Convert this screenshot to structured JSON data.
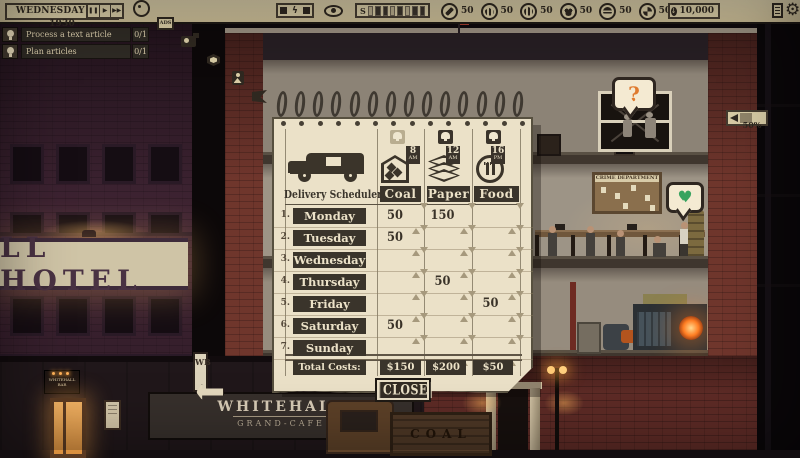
{
  "top_bar": {
    "date": "WEDNESDAY JAN 1930",
    "speed": {
      "pause": "❚❚",
      "play": "▶",
      "fast": "▶▶"
    },
    "ads_label": "ADS",
    "bolt": "ϟ",
    "s_label": "S",
    "stats": [
      {
        "icon": "leaf-circle-icon",
        "value": "50"
      },
      {
        "icon": "industry-circle-icon",
        "value": "50"
      },
      {
        "icon": "bank-circle-icon",
        "value": "50"
      },
      {
        "icon": "crowd-circle-icon",
        "value": "50"
      },
      {
        "icon": "portrait-circle-icon",
        "value": "50"
      },
      {
        "icon": "emblem-circle-icon",
        "value": "50"
      }
    ],
    "money": "10,000",
    "circulation": "50%"
  },
  "tasks": [
    {
      "label": "Process a text article",
      "progress": "0/1"
    },
    {
      "label": "Plan articles",
      "progress": "0/1"
    }
  ],
  "scheduler": {
    "title": "Delivery Scheduler",
    "columns": [
      {
        "label": "Coal",
        "hour": "8",
        "meridiem": "AM",
        "bell_active": false
      },
      {
        "label": "Paper",
        "hour": "12",
        "meridiem": "AM",
        "bell_active": true
      },
      {
        "label": "Food",
        "hour": "16",
        "meridiem": "PM",
        "bell_active": true
      }
    ],
    "rows": [
      {
        "num": "1.",
        "day": "Monday",
        "values": {
          "coal": "50",
          "paper": "150",
          "food": ""
        }
      },
      {
        "num": "2.",
        "day": "Tuesday",
        "values": {
          "coal": "50",
          "paper": "",
          "food": ""
        }
      },
      {
        "num": "3.",
        "day": "Wednesday",
        "values": {
          "coal": "",
          "paper": "",
          "food": ""
        }
      },
      {
        "num": "4.",
        "day": "Thursday",
        "values": {
          "coal": "",
          "paper": "50",
          "food": ""
        }
      },
      {
        "num": "5.",
        "day": "Friday",
        "values": {
          "coal": "",
          "paper": "",
          "food": "50"
        }
      },
      {
        "num": "6.",
        "day": "Saturday",
        "values": {
          "coal": "50",
          "paper": "",
          "food": ""
        }
      },
      {
        "num": "7.",
        "day": "Sunday",
        "values": {
          "coal": "",
          "paper": "",
          "food": ""
        }
      }
    ],
    "totals_label": "Total Costs:",
    "totals": [
      "$150",
      "$200",
      "$50"
    ],
    "close_label": "CLOSE"
  },
  "scene": {
    "hotel_sign": "LL HOTEL",
    "cafe_sign": "WHITEHALL",
    "cafe_sign_sub": "GRAND-CAFE",
    "bar_sign_line1": "WHITEHALL",
    "bar_sign_line2": "BAR",
    "poster": "WB",
    "crime_board": "CRIME DEPARTMENT",
    "truck_side": "COAL",
    "question_bubble": "?",
    "heart_glyph": "♥"
  },
  "colors": {
    "paper": "#ebe1c8",
    "ink": "#3a342b",
    "topbar": "#d2c5a0",
    "accent_orange": "#df7a2e",
    "accent_green": "#37a35f",
    "brick": "#74382e"
  }
}
